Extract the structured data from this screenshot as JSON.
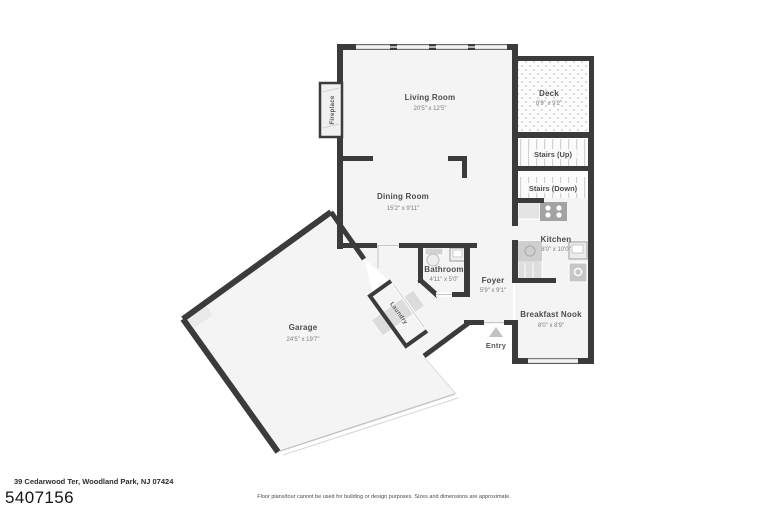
{
  "rooms": {
    "living": {
      "name": "Living Room",
      "dims": "20'5\" x 12'5\""
    },
    "dining": {
      "name": "Dining Room",
      "dims": "15'2\" x 9'11\""
    },
    "deck": {
      "name": "Deck",
      "dims": "8'9\" x 9'2\""
    },
    "stairs_up": {
      "name": "Stairs (Up)"
    },
    "stairs_down": {
      "name": "Stairs (Down)"
    },
    "kitchen": {
      "name": "Kitchen",
      "dims": "8'0\" x 10'0\""
    },
    "bathroom": {
      "name": "Bathroom",
      "dims": "4'11\" x 5'0\""
    },
    "foyer": {
      "name": "Foyer",
      "dims": "5'9\" x 9'1\""
    },
    "breakfast_nook": {
      "name": "Breakfast Nook",
      "dims": "8'0\" x 8'9\""
    },
    "garage": {
      "name": "Garage",
      "dims": "24'5\" x 19'7\""
    },
    "laundry": {
      "name": "Laundry"
    },
    "fireplace": {
      "name": "Fireplace"
    },
    "entry": {
      "name": "Entry"
    }
  },
  "footer": {
    "address": "39 Cedarwood Ter, Woodland Park, NJ 07424",
    "listing_id": "5407156",
    "disclaimer": "Floor plans/tour cannot be used for building or design purposes. Sizes and dimensions are approximate."
  },
  "colors": {
    "wall": "#3b3b3b",
    "room_fill": "#f4f4f4",
    "pattern_line": "#d2d2d2"
  }
}
